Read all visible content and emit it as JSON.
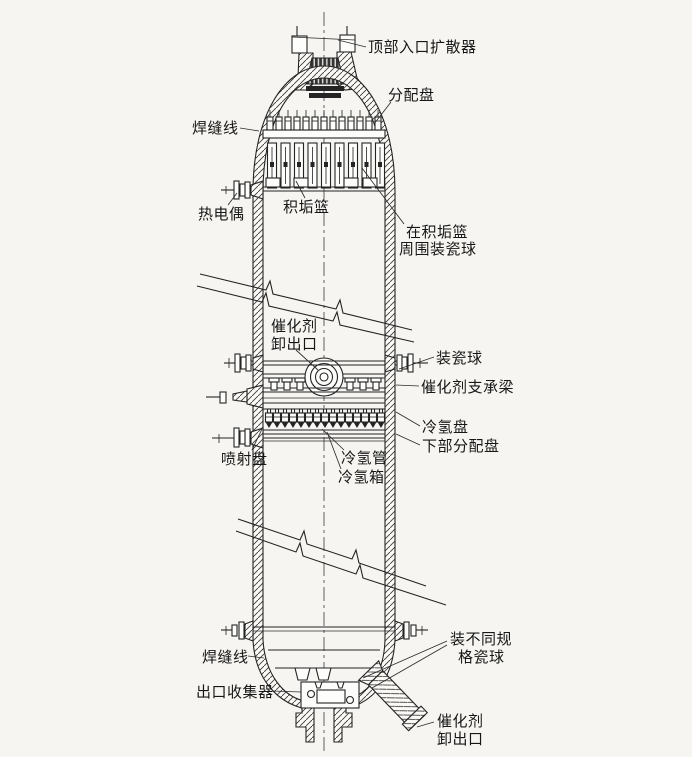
{
  "figure": {
    "kind": "engineering-cross-section-diagram",
    "subject": "catalytic hydrogenation reactor vessel internals",
    "language": "zh-CN"
  },
  "colors": {
    "paper": "#f6f5f1",
    "ink": "#242424"
  },
  "labels": {
    "top_inlet_diffuser": "顶部入口扩散器",
    "distribution_tray": "分配盘",
    "weld_line_top": "焊缝线",
    "thermocouple": "热电偶",
    "scale_basket": "积垢篮",
    "balls_around_basket_1": "在积垢篮",
    "balls_around_basket_2": "周围装瓷球",
    "catalyst_unload_mid_1": "催化剂",
    "catalyst_unload_mid_2": "卸出口",
    "load_ceramic_balls": "装瓷球",
    "catalyst_support_beam": "催化剂支承梁",
    "cold_hydrogen_tray": "冷氢盘",
    "lower_distribution_tray": "下部分配盘",
    "spray_tray": "喷射盘",
    "cold_hydrogen_pipe": "冷氢管",
    "cold_hydrogen_box": "冷氢箱",
    "weld_line_bottom": "焊缝线",
    "outlet_collector": "出口收集器",
    "graded_ceramic_balls_1": "装不同规",
    "graded_ceramic_balls_2": "格瓷球",
    "catalyst_unload_bottom_1": "催化剂",
    "catalyst_unload_bottom_2": "卸出口"
  }
}
